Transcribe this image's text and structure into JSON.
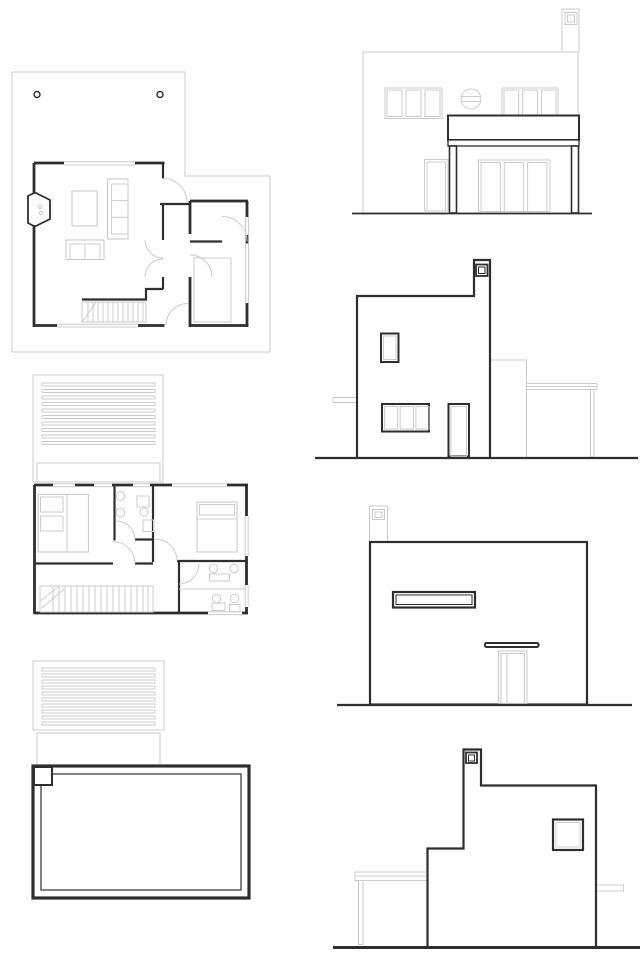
{
  "sheet": {
    "title": "house-plans-and-elevations-sheet",
    "drawings": [
      {
        "id": "ground-floor-plan",
        "kind": "floor-plan",
        "position": "top-left"
      },
      {
        "id": "first-floor-plan",
        "kind": "floor-plan",
        "position": "middle-left"
      },
      {
        "id": "roof-plan",
        "kind": "roof-plan",
        "position": "bottom-left"
      },
      {
        "id": "front-elevation",
        "kind": "elevation",
        "position": "top-right"
      },
      {
        "id": "right-side-elevation",
        "kind": "elevation",
        "position": "right-second"
      },
      {
        "id": "rear-elevation",
        "kind": "elevation",
        "position": "right-third"
      },
      {
        "id": "left-side-elevation",
        "kind": "elevation",
        "position": "bottom-right"
      }
    ]
  },
  "colors": {
    "line_dark": "#2e2e2e",
    "line_light": "#cccccc",
    "background": "#ffffff"
  }
}
